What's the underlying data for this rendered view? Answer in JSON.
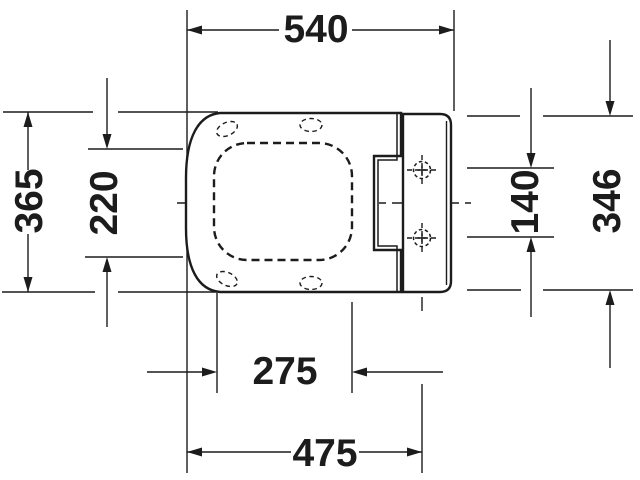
{
  "colors": {
    "background": "#ffffff",
    "line": "#1c1c1c"
  },
  "dimensions": {
    "overall_width": "540",
    "overall_depth": "365",
    "seat_opening_depth": "220",
    "hinge_hole_spacing": "140",
    "mounting_plate_length": "346",
    "seat_opening_width": "275",
    "front_to_mounting_holes": "475"
  }
}
